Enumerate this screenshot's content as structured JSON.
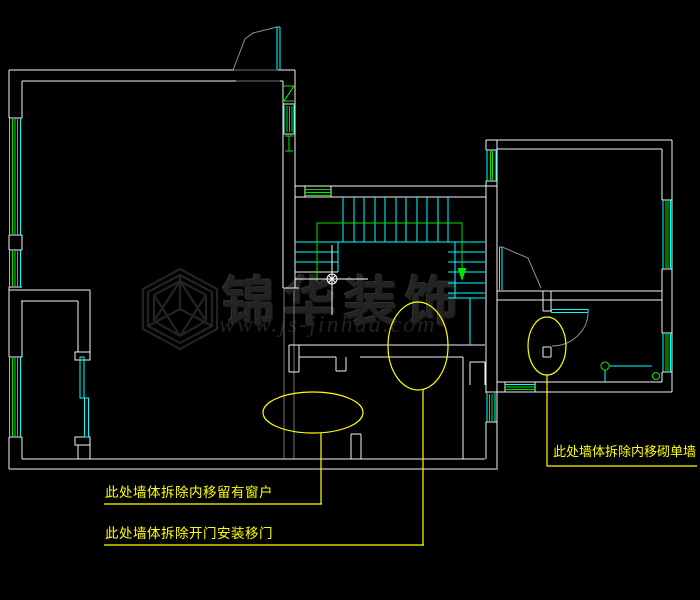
{
  "drawing": {
    "kind": "cad-floorplan-demolition-plan",
    "background": "#000000"
  },
  "annotations": {
    "left_window": {
      "text": "此处墙体拆除内移留有窗户"
    },
    "sliding_door": {
      "text": "此处墙体拆除开门安装移门"
    },
    "single_wall": {
      "text": "此处墙体拆除内移砌单墙"
    }
  },
  "watermark": {
    "brand": "锦华装饰",
    "url": "www.js-jinhua.com",
    "logo_icon": "jinhua-cube-logo"
  },
  "cursor": {
    "icon": "crosshair-point-marker",
    "x": 332,
    "y": 279
  },
  "colors": {
    "wall": "#ffffff",
    "window_frame": "#00ffff",
    "glazing_and_marks": "#00ff00",
    "highlight": "#ffff00",
    "demolished_wall": "#787878",
    "door_swing": "#8f8f8f",
    "watermark": "#232323"
  }
}
